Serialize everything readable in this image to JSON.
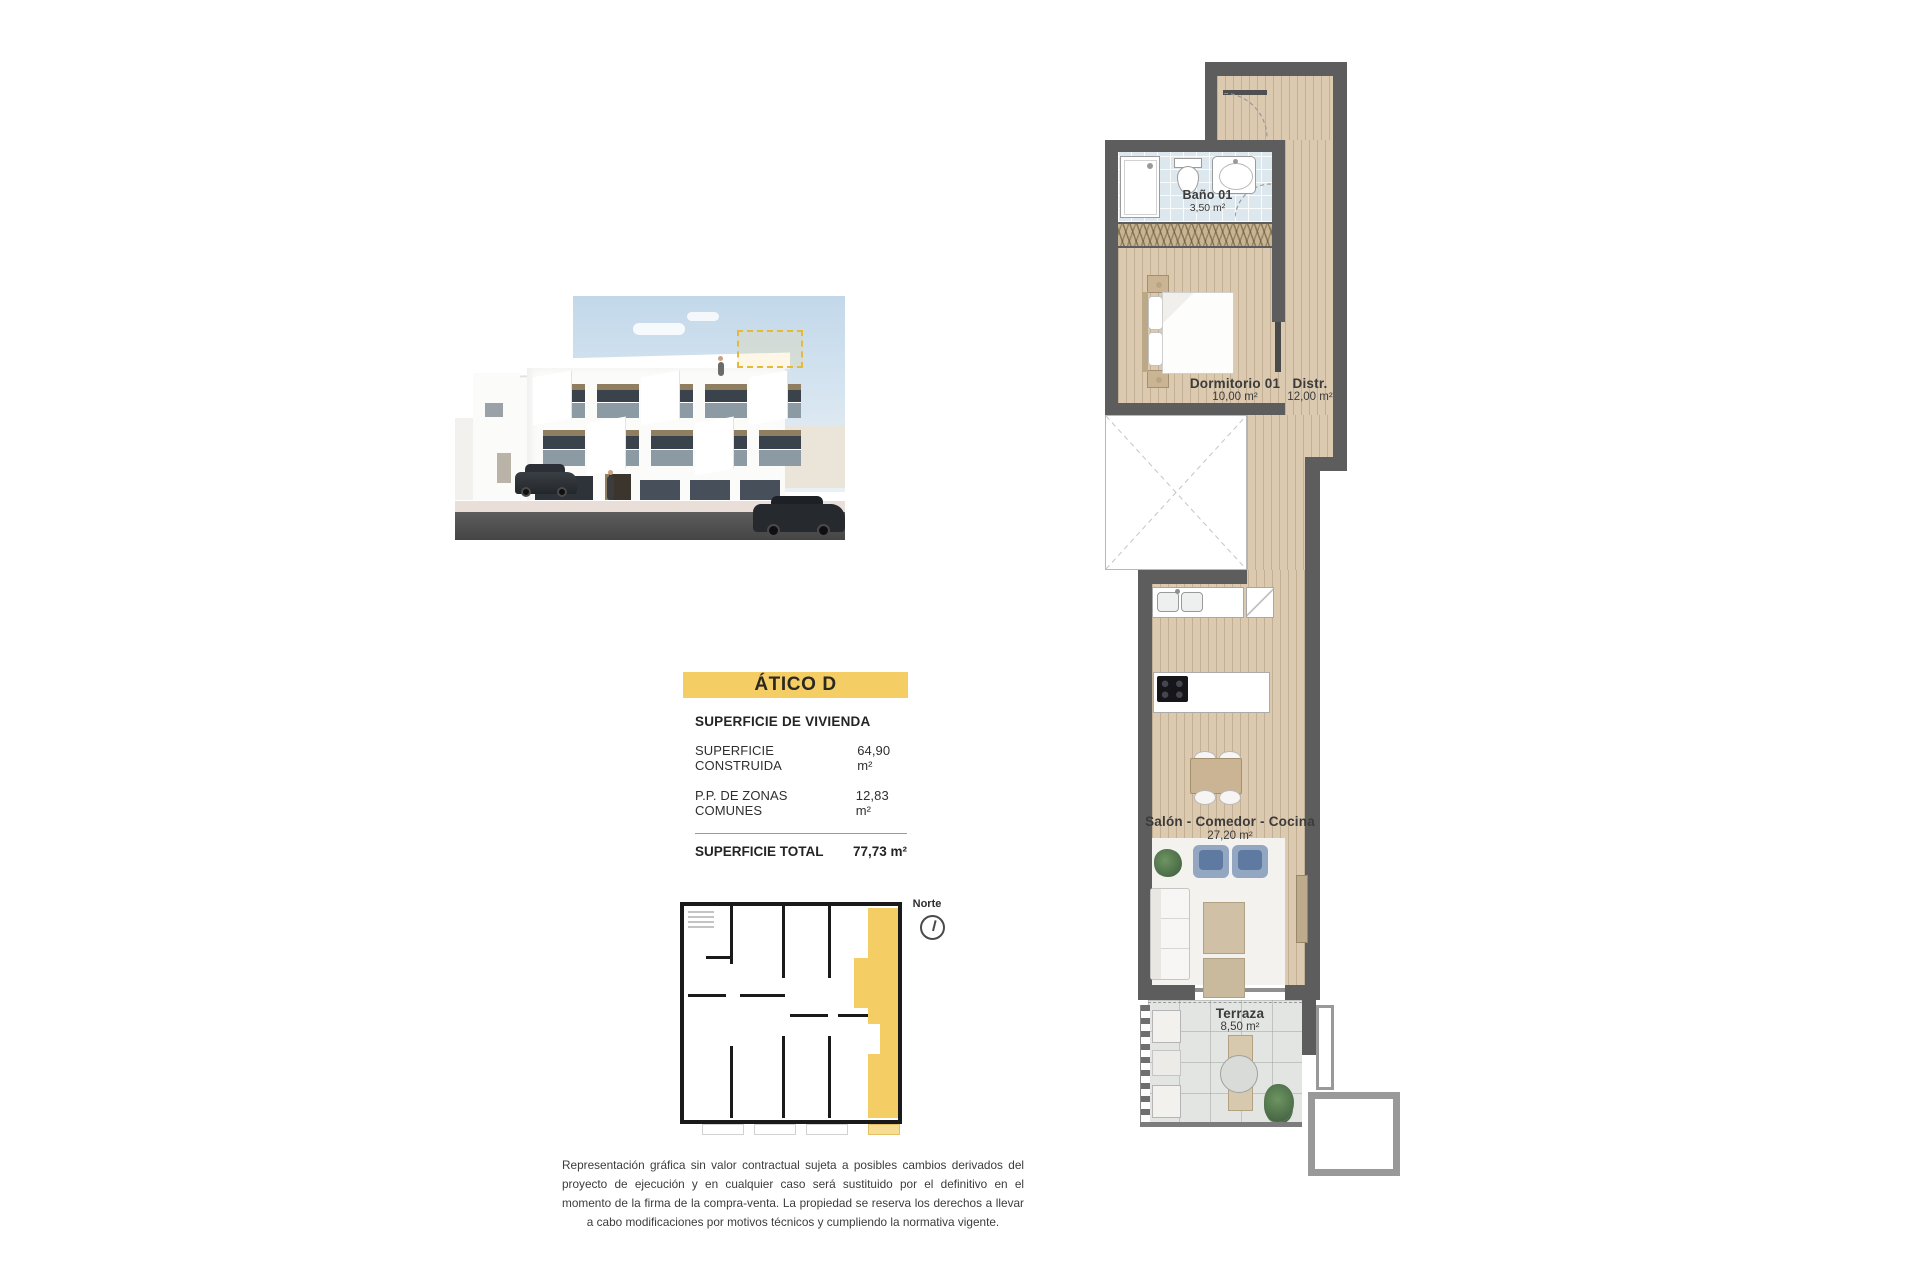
{
  "banner": {
    "title": "ÁTICO D"
  },
  "surface": {
    "title": "SUPERFICIE DE VIVIENDA",
    "rows": [
      {
        "label": "SUPERFICIE CONSTRUIDA",
        "value": "64,90 m²"
      },
      {
        "label": "P.P. DE ZONAS COMUNES",
        "value": "12,83 m²"
      }
    ],
    "total_label": "SUPERFICIE TOTAL",
    "total_value": "77,73 m²"
  },
  "key_plan": {
    "north_label": "Norte"
  },
  "plan": {
    "bath": {
      "name": "Baño 01",
      "area": "3,50 m²"
    },
    "bedroom": {
      "name": "Dormitorio 01",
      "area": "10,00 m²"
    },
    "distributor": {
      "name": "Distr.",
      "area": "12,00 m²"
    },
    "living": {
      "name": "Salón - Comedor - Cocina",
      "area": "27,20 m²"
    },
    "terrace": {
      "name": "Terraza",
      "area": "8,50 m²"
    }
  },
  "disclaimer": "Representación gráfica sin valor contractual sujeta a posibles cambios derivados del proyecto de ejecución y en cualquier caso será sustituido por el definitivo en el momento de la firma de la compra-venta. La propiedad se reserva los derechos a llevar a cabo modificaciones por motivos técnicos y cumpliendo la normativa vigente.",
  "colors": {
    "accent_yellow": "#f4cd64",
    "wall_gray": "#5d5d5d",
    "wood_floor": "#dbc9b0",
    "bath_tile": "#dde8ee",
    "terrace_tile": "#e3e5e2"
  }
}
